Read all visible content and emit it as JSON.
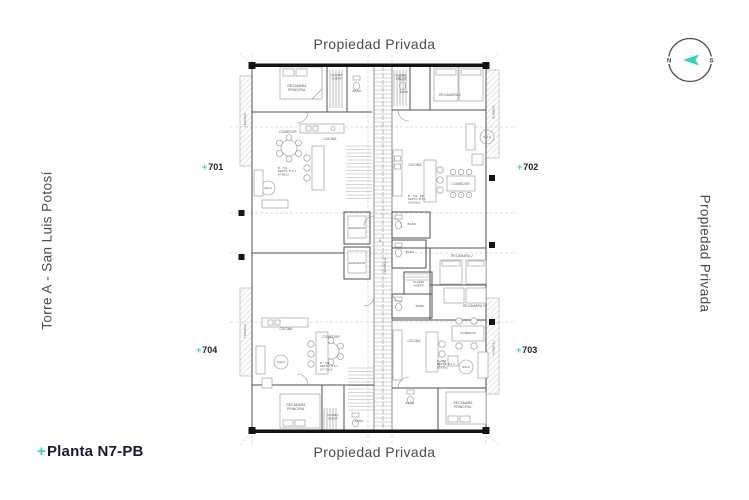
{
  "colors": {
    "accent": "#2fd6b7",
    "ink": "#4a4a50",
    "plan_line": "#55555c",
    "title_dark": "#17173a"
  },
  "titles": {
    "top": "Propiedad Privada",
    "bottom": "Propiedad Privada",
    "left": "Torre A - San Luis Potosí",
    "right": "Propiedad Privada"
  },
  "plan_name": {
    "plus": "+",
    "text": "Planta N7-PB"
  },
  "compass": {
    "west": "N",
    "east": "S"
  },
  "plan": {
    "units": [
      {
        "plus": "+",
        "number": "701"
      },
      {
        "plus": "+",
        "number": "702"
      },
      {
        "plus": "+",
        "number": "703"
      },
      {
        "plus": "+",
        "number": "704"
      }
    ],
    "labels": [
      {
        "lines": [
          "RECÁMARA",
          "PRINCIPAL"
        ],
        "x": 297,
        "y": 87
      },
      {
        "lines": [
          "CLOSET",
          "HUÉSP."
        ],
        "x": 337,
        "y": 76,
        "s": 2.7
      },
      {
        "t": "BAÑO",
        "x": 357,
        "y": 92,
        "s": 2.9
      },
      {
        "t": "COMEDOR",
        "x": 288,
        "y": 133
      },
      {
        "t": "COCINA",
        "x": 330,
        "y": 140
      },
      {
        "t": "SALA",
        "x": 268,
        "y": 189,
        "s": 2.9
      },
      {
        "lines": [
          "B - 701",
          "DEPTO. B 2.4",
          "87.80m2"
        ],
        "x": 278,
        "y": 169,
        "s": 2.6,
        "a": "start"
      },
      {
        "lines": [
          "CLOSET",
          "HUÉSP."
        ],
        "x": 401,
        "y": 76,
        "s": 2.7
      },
      {
        "t": "BAÑO",
        "x": 404,
        "y": 93,
        "s": 2.9
      },
      {
        "t": "RECÁMARA 2",
        "x": 450,
        "y": 96
      },
      {
        "t": "SALA",
        "x": 487,
        "y": 138,
        "s": 2.9
      },
      {
        "t": "COCINA",
        "x": 415,
        "y": 166
      },
      {
        "t": "COMEDOR",
        "x": 461,
        "y": 185
      },
      {
        "lines": [
          "B - 702 - PB",
          "DEPTO. B 5.1",
          "106.00m2"
        ],
        "x": 408,
        "y": 197,
        "s": 2.6,
        "a": "start"
      },
      {
        "t": "TERRAZA",
        "x": 492.5,
        "y": 112,
        "r": 90,
        "s": 2.8
      },
      {
        "t": "ELEVADOR",
        "x": 357,
        "y": 229,
        "s": 2.8
      },
      {
        "t": "ELEVADOR",
        "x": 357,
        "y": 264,
        "s": 2.8
      },
      {
        "t": "BAÑO",
        "x": 412,
        "y": 225,
        "s": 2.9
      },
      {
        "t": "BAÑO",
        "x": 410,
        "y": 253,
        "s": 2.9
      },
      {
        "t": "N7",
        "x": 381,
        "y": 240,
        "r": -90,
        "s": 3
      },
      {
        "t": "VESTÍBULO",
        "x": 386,
        "y": 266,
        "r": -90,
        "s": 2.7
      },
      {
        "lines": [
          "CLOSET",
          "HUÉSP."
        ],
        "x": 419,
        "y": 283,
        "s": 2.7
      },
      {
        "t": "BAÑO",
        "x": 420,
        "y": 307,
        "s": 2.9
      },
      {
        "t": "RECÁMARA 2",
        "x": 462,
        "y": 257
      },
      {
        "t": "RECÁMARA 3",
        "x": 474,
        "y": 307
      },
      {
        "t": "COCINA",
        "x": 414,
        "y": 342
      },
      {
        "t": "COMEDOR",
        "x": 468,
        "y": 334,
        "s": 2.8
      },
      {
        "t": "SALA",
        "x": 466,
        "y": 368,
        "s": 2.9
      },
      {
        "lines": [
          "B - 703",
          "DEPTO. B 4.2",
          "85.17m2"
        ],
        "x": 437,
        "y": 362,
        "s": 2.6,
        "a": "start"
      },
      {
        "t": "BAÑO",
        "x": 410,
        "y": 404,
        "s": 2.9
      },
      {
        "lines": [
          "RECÁMARA",
          "PRINCIPAL"
        ],
        "x": 463,
        "y": 404
      },
      {
        "t": "TERRAZA",
        "x": 492.5,
        "y": 348,
        "r": 90,
        "s": 2.8
      },
      {
        "t": "COCINA",
        "x": 286,
        "y": 330
      },
      {
        "t": "COMEDOR",
        "x": 331,
        "y": 338
      },
      {
        "t": "SALA",
        "x": 281,
        "y": 363,
        "s": 2.9
      },
      {
        "lines": [
          "B - 704",
          "DEPTO. B 6.1",
          "107.22m2"
        ],
        "x": 320,
        "y": 364,
        "s": 2.6,
        "a": "start"
      },
      {
        "lines": [
          "RECÁMARA",
          "PRINCIPAL"
        ],
        "x": 296,
        "y": 406
      },
      {
        "lines": [
          "CLOSET",
          "HUÉSP."
        ],
        "x": 333,
        "y": 416,
        "s": 2.7
      },
      {
        "t": "BAÑO",
        "x": 359,
        "y": 422,
        "s": 2.9
      },
      {
        "t": "TERRAZA",
        "x": 246,
        "y": 120,
        "r": -90,
        "s": 2.8
      },
      {
        "t": "TERRAZA",
        "x": 246,
        "y": 331,
        "r": -90,
        "s": 2.8
      }
    ]
  }
}
